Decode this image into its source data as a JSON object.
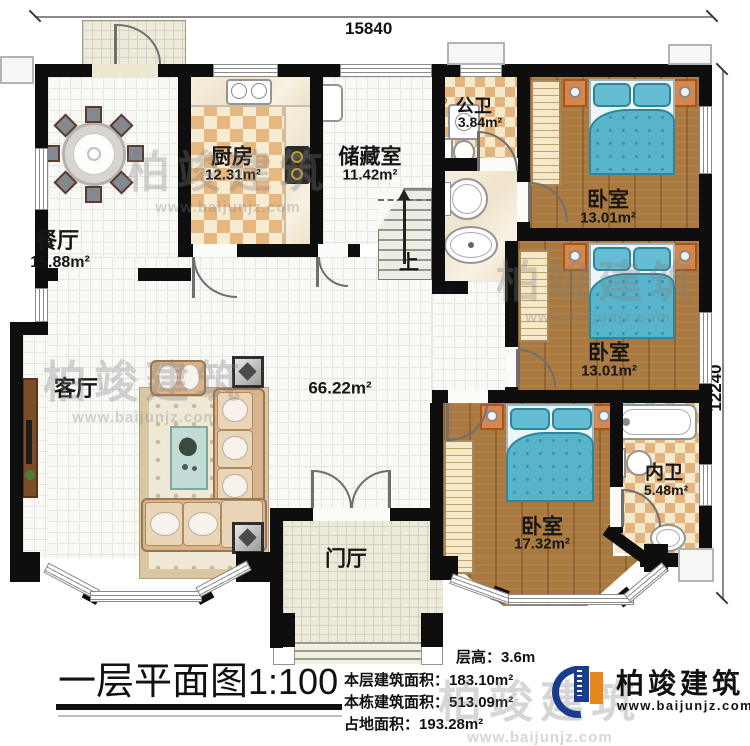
{
  "dimensions": {
    "top": "15840",
    "right": "12240"
  },
  "rooms": {
    "dining": {
      "name": "餐厅",
      "area": "15.88m²"
    },
    "kitchen": {
      "name": "厨房",
      "area": "12.31m²"
    },
    "storage": {
      "name": "储藏室",
      "area": "11.42m²"
    },
    "public_bath": {
      "name": "公卫",
      "area": "3.84m²"
    },
    "bedroom1": {
      "name": "卧室",
      "area": "13.01m²"
    },
    "bedroom2": {
      "name": "卧室",
      "area": "13.01m²"
    },
    "bedroom3": {
      "name": "卧室",
      "area": "17.32m²"
    },
    "inner_bath": {
      "name": "内卫",
      "area": "5.48m²"
    },
    "living": {
      "name": "客厅",
      "area": "66.22m²"
    },
    "foyer": {
      "name": "门厅"
    }
  },
  "stairs": {
    "up_label": "上"
  },
  "title": {
    "text": "一层平面图",
    "scale": "1:100"
  },
  "info_lines": [
    {
      "label": "层高：",
      "value": "3.6m"
    },
    {
      "label": "本层建筑面积：",
      "value": "183.10m²"
    },
    {
      "label": "本栋建筑面积：",
      "value": "513.09m²"
    },
    {
      "label": "占地面积：",
      "value": "193.28m²"
    }
  ],
  "logo": {
    "company": "柏竣建筑",
    "website": "www.baijunjz.com"
  },
  "watermark": {
    "line1": "柏竣建筑",
    "line2": "www.baijunjz.com"
  },
  "colors": {
    "wall": "#0e0e0e",
    "wood_floor": "#a9793f",
    "bed": "#58b4cb",
    "checker": "#e6b77f",
    "logo_blue": "#1a3c8c",
    "logo_orange": "#e8871a"
  }
}
